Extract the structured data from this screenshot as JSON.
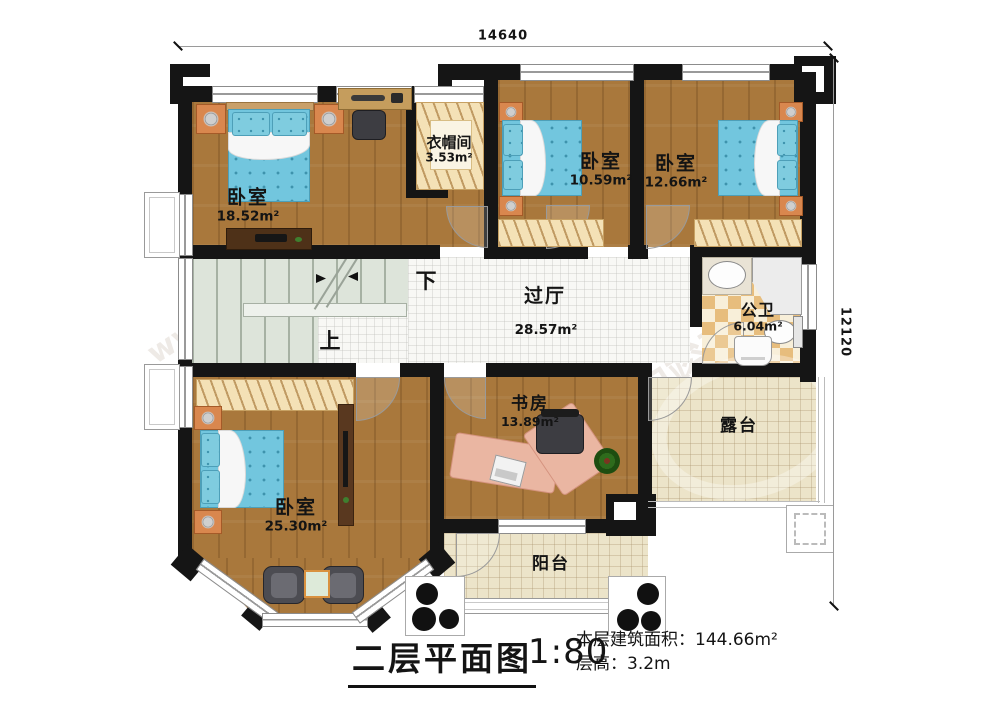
{
  "dimensions": {
    "width_label": "14640",
    "height_label": "12120"
  },
  "rooms": {
    "bedroom_nw": {
      "name": "卧室",
      "area": "18.52m²"
    },
    "cloakroom": {
      "name": "衣帽间",
      "area": "3.53m²"
    },
    "bedroom_n": {
      "name": "卧室",
      "area": "10.59m²"
    },
    "bedroom_ne": {
      "name": "卧室",
      "area": "12.66m²"
    },
    "hall": {
      "name": "过厅",
      "area": "28.57m²"
    },
    "bathroom": {
      "name": "公卫",
      "area": "6.04m²"
    },
    "bedroom_sw": {
      "name": "卧室",
      "area": "25.30m²"
    },
    "study": {
      "name": "书房",
      "area": "13.89m²"
    },
    "terrace": {
      "name": "露台"
    },
    "balcony": {
      "name": "阳台"
    }
  },
  "stairs": {
    "up": "上",
    "down": "下"
  },
  "footer": {
    "title": "二层平面图",
    "scale": "1:80",
    "area_line": "本层建筑面积：144.66m²",
    "height_line": "层高：3.2m"
  },
  "watermark": {
    "site": "www.baijz.com",
    "brand": "柏竣建筑"
  },
  "colors": {
    "wall": "#151515",
    "wood_floor": "#a9783c",
    "hall_tile": "#f8f8f5",
    "terrace_tile": "#ece4c9",
    "bathroom_checker": "#e7bd7d",
    "stair_tread": "#dde4da",
    "bed_blue": "#72c6de",
    "closet_tan": "#f4e1b6",
    "nightstand_orange": "#d9874e",
    "desk_pink": "#eab6a2"
  }
}
